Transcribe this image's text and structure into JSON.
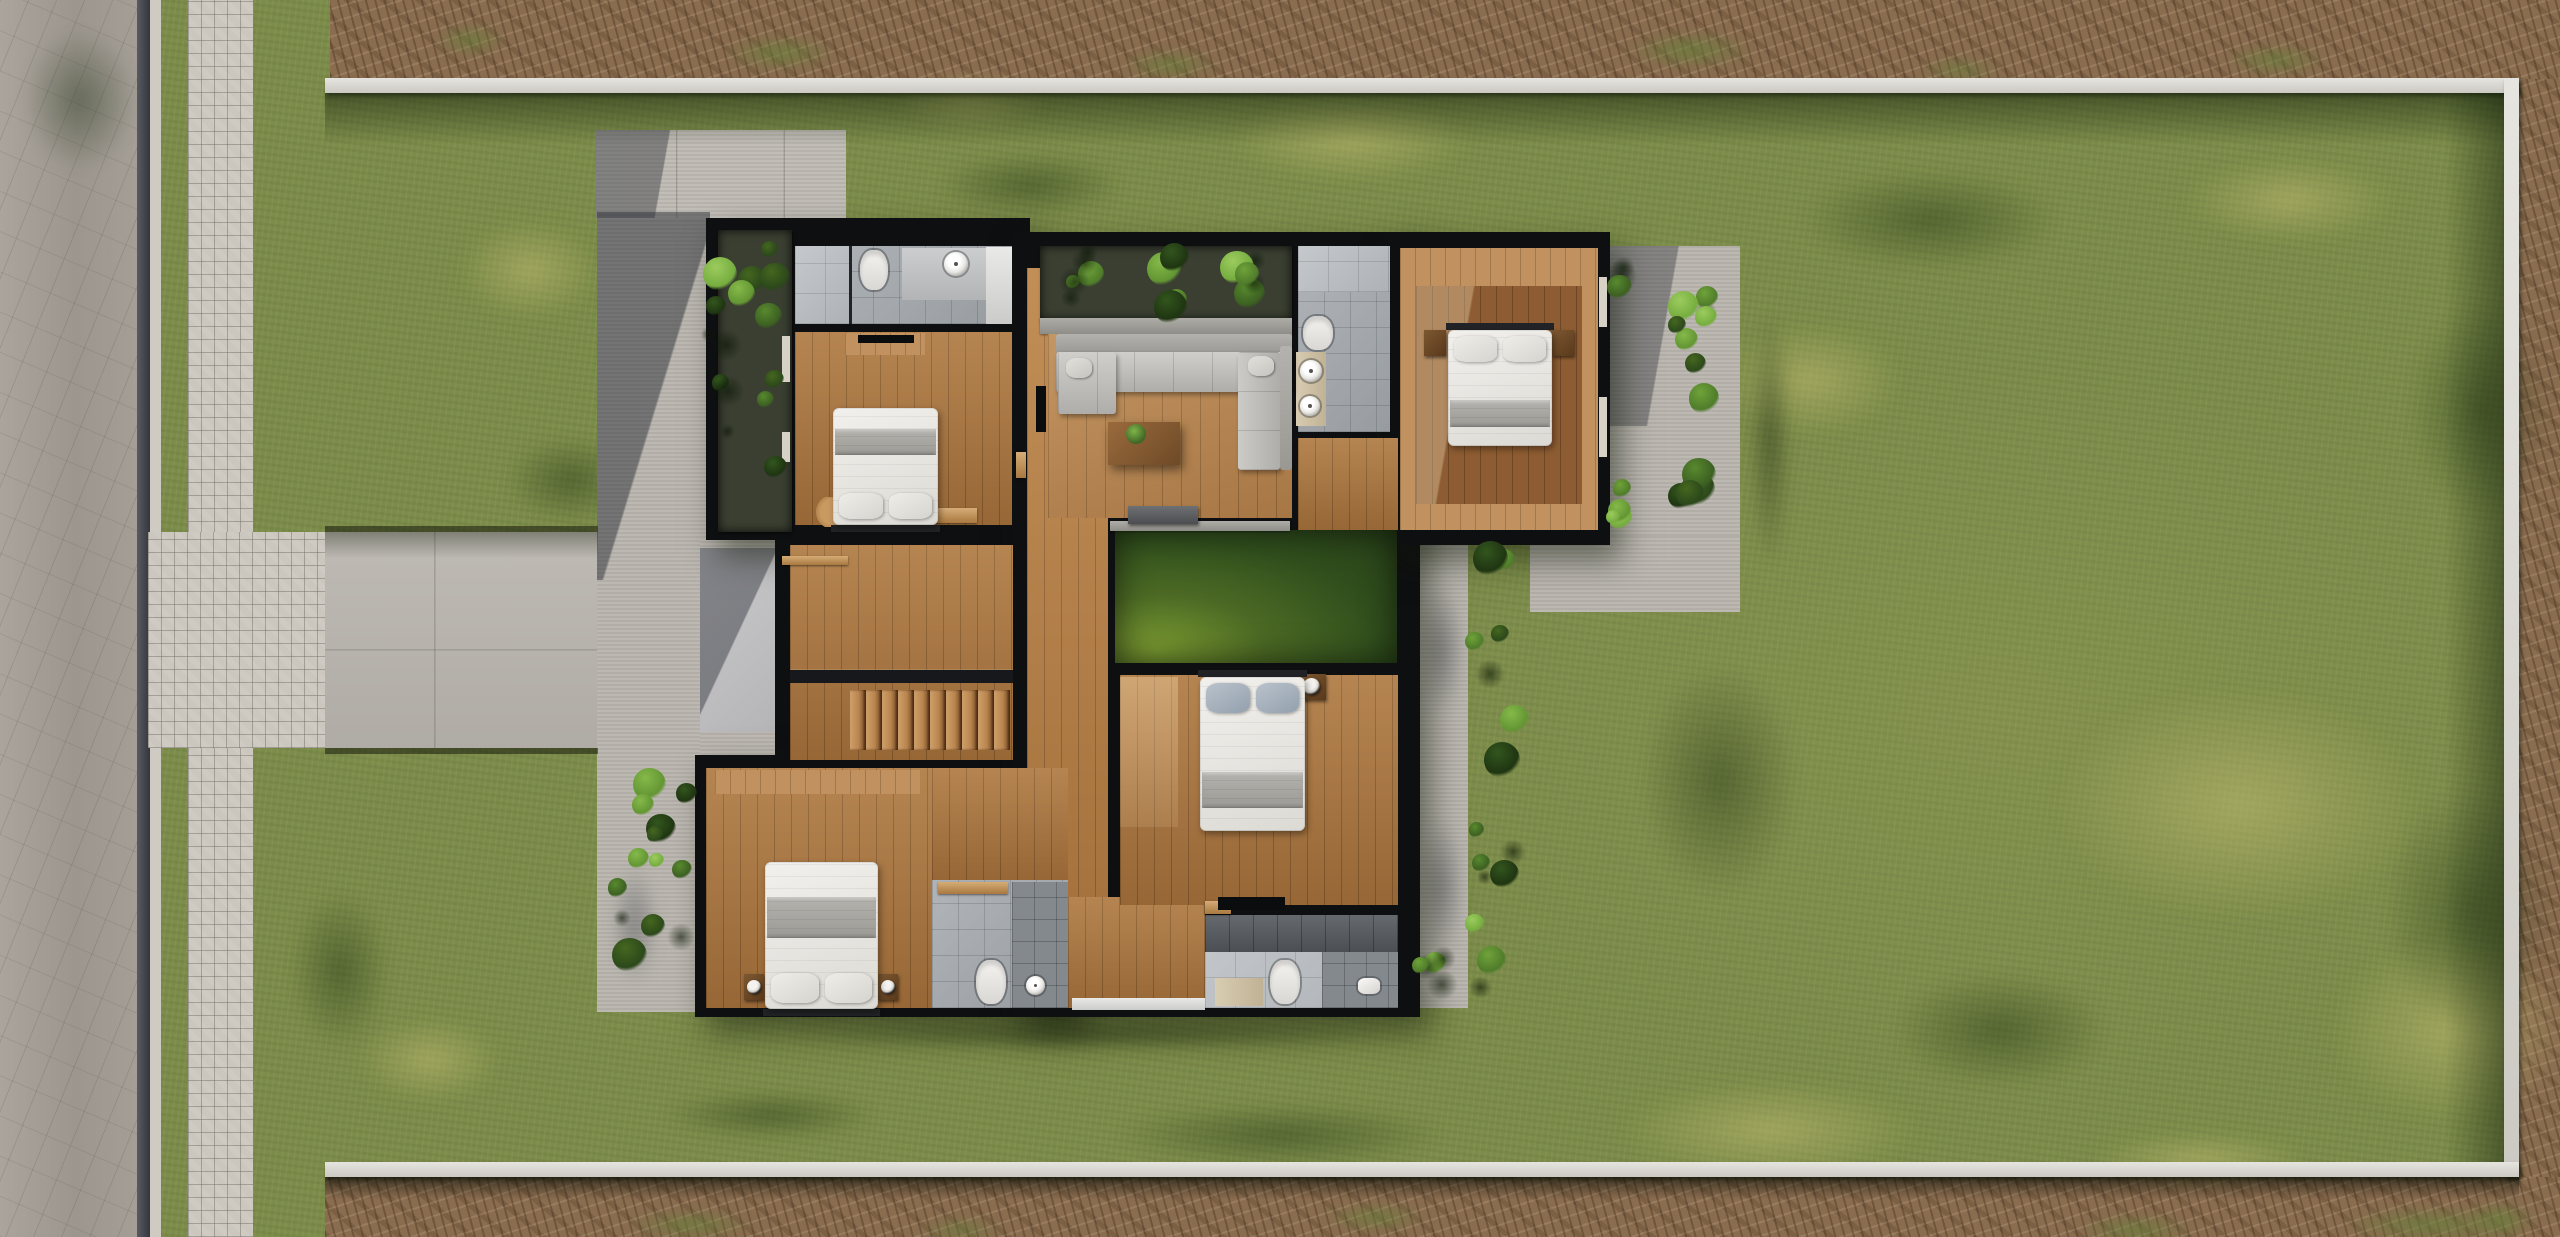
{
  "meta": {
    "scene": "photorealistic-aerial-architectural-floor-plan-render",
    "view": "top-down",
    "site": "walled rectangular lot with lawn, street and paver walkway on west side, dirt verge outside walls",
    "house": "modern single-family upper floor with 4 bedrooms, 4 bathrooms, living room, interior atrium planter, grass courtyard, staircase, terraces and perimeter planters"
  },
  "palette": {
    "grass": "#7c8c4a",
    "road": "#a19b94",
    "paver": "#cbc6be",
    "dirt": "#8a6c4f",
    "concrete": "#b9b5ae",
    "wall_white": "#dcd9d3",
    "black": "#0e0f11",
    "wood": "#a9753f",
    "woodL": "#c1925f",
    "woodD": "#8d5c32",
    "tile": "#a4a9ae",
    "tileL": "#b8bdc1",
    "tileD": "#84898e",
    "court_green": "#31501d",
    "sofa_gray": "#bdbcb8",
    "bed_white": "#e9e7e2",
    "bed_gray": "#a9a7a2",
    "pillow_blue": "#a6b0bb",
    "leaf_green": "#4f7c2a"
  },
  "regions": [
    [
      "lawn",
      "lawn",
      0,
      0,
      2560,
      1237,
      0
    ],
    [
      "road",
      "road r",
      0,
      0,
      137,
      1237,
      0
    ],
    [
      "curb-line",
      "curbD",
      137,
      0,
      13,
      1237,
      0
    ],
    [
      "curb-strip",
      "curbL",
      150,
      0,
      11,
      1237,
      0
    ],
    [
      "paver-walkway",
      "paver",
      188,
      0,
      65,
      1237,
      0
    ],
    [
      "dirt-strip-top",
      "dirt",
      330,
      0,
      2230,
      79,
      0
    ],
    [
      "dirt-strip-right",
      "dirt",
      2519,
      79,
      41,
      1158,
      0
    ],
    [
      "dirt-strip-bottom",
      "dirt",
      325,
      1177,
      2235,
      60,
      0
    ],
    [
      "paver-driveway",
      "paver",
      148,
      532,
      177,
      216,
      2
    ],
    [
      "driveway-concrete",
      "drive",
      325,
      532,
      273,
      216,
      2
    ],
    [
      "patio-west",
      "conc",
      597,
      212,
      113,
      800,
      2
    ],
    [
      "patio-entry",
      "conc",
      700,
      540,
      92,
      225,
      2
    ],
    [
      "concrete-pad-north",
      "concP",
      596,
      130,
      250,
      88,
      2
    ],
    [
      "porch-slab",
      "concL",
      700,
      548,
      85,
      184,
      2
    ],
    [
      "terrace-east-upper",
      "conc",
      1610,
      246,
      130,
      292,
      2
    ],
    [
      "terrace-east-lower",
      "conc",
      1530,
      536,
      210,
      76,
      2
    ],
    [
      "walkway-east",
      "conc",
      1406,
      536,
      62,
      472,
      2
    ],
    [
      "boundary-wall-top",
      "wallW",
      325,
      78,
      2194,
      15,
      2
    ],
    [
      "boundary-wall-right",
      "wallW",
      2504,
      78,
      15,
      1099,
      2
    ],
    [
      "boundary-wall-bottom",
      "wallW",
      325,
      1162,
      2194,
      15,
      2
    ],
    [
      "wall-top-shadow",
      "shadeT",
      325,
      93,
      2179,
      52,
      3
    ],
    [
      "wall-right-shadow",
      "shadeR",
      2444,
      93,
      60,
      1069,
      3
    ],
    [
      "wall-bottom-outer-shadow",
      "shadeB",
      325,
      1177,
      2194,
      22,
      3
    ],
    [
      "lawn-edge-top",
      "edge",
      325,
      526,
      273,
      6,
      3
    ],
    [
      "lawn-edge-bottom",
      "edge",
      325,
      748,
      273,
      6,
      3
    ],
    [
      "driveway-shadow",
      "grad",
      325,
      532,
      273,
      26,
      3,
      "background:linear-gradient(180deg,rgba(35,40,25,.4),rgba(0,0,0,0))"
    ],
    [
      "patio-shadow",
      "grad",
      597,
      212,
      113,
      368,
      3,
      "background:linear-gradient(107deg,rgba(44,47,55,.5) 52%,rgba(0,0,0,0) 53%)"
    ],
    [
      "pad-shadow",
      "grad",
      596,
      130,
      118,
      88,
      3,
      "background:linear-gradient(100deg,rgba(44,47,55,.42) 55%,rgba(0,0,0,0) 56%)"
    ],
    [
      "porch-shadow",
      "grad",
      700,
      548,
      85,
      184,
      3,
      "background:linear-gradient(115deg,rgba(44,47,55,.45) 45%,rgba(0,0,0,0) 46%)"
    ],
    [
      "terrace-shadow",
      "grad",
      1610,
      246,
      130,
      180,
      3,
      "background:linear-gradient(100deg,rgba(44,47,55,.38) 42%,rgba(0,0,0,0) 43%)"
    ],
    [
      "house-base-northwest",
      "black hshadow",
      706,
      218,
      324,
      322,
      4
    ],
    [
      "house-base-stairwell",
      "black",
      775,
      540,
      255,
      230,
      4
    ],
    [
      "house-base-southwest",
      "black hshadow",
      695,
      755,
      380,
      262,
      4
    ],
    [
      "house-base-core",
      "black hshadow",
      1012,
      232,
      408,
      785,
      4
    ],
    [
      "house-base-northeast",
      "black hshadow",
      1385,
      232,
      225,
      313,
      4
    ],
    [
      "planter-west-box",
      "pbox",
      718,
      230,
      74,
      302,
      5
    ],
    [
      "bath1-floor",
      "tile",
      795,
      246,
      217,
      78,
      5
    ],
    [
      "bath1-shower",
      "tileL",
      795,
      246,
      56,
      78,
      5
    ],
    [
      "bath1-glass-partition",
      "glass",
      849,
      246,
      3,
      78,
      5
    ],
    [
      "bath1-counter",
      "counter",
      902,
      248,
      84,
      52,
      5
    ],
    [
      "bath1-column",
      "counterW",
      986,
      247,
      26,
      77,
      5
    ],
    [
      "bedroom1-floor",
      "wood",
      795,
      332,
      217,
      193,
      5
    ],
    [
      "bedroom1-dresser",
      "woodL",
      845,
      333,
      80,
      22,
      5
    ],
    [
      "hall-floor",
      "wood",
      1027,
      268,
      81,
      740,
      5,
      "filter:brightness(1.07)"
    ],
    [
      "atrium-planter-box",
      "pbox",
      1040,
      246,
      252,
      74,
      5
    ],
    [
      "living-ledge",
      "ledge",
      1040,
      318,
      252,
      16,
      5
    ],
    [
      "living-floor",
      "woodG",
      1048,
      334,
      244,
      184,
      5
    ],
    [
      "hall2-floor",
      "wood",
      1298,
      438,
      100,
      92,
      5
    ],
    [
      "bath2-floor",
      "tile",
      1298,
      246,
      92,
      186,
      5
    ],
    [
      "bath2-shower",
      "tileL",
      1298,
      246,
      92,
      46,
      5
    ],
    [
      "bath2-vanity",
      "vanity",
      1296,
      352,
      30,
      74,
      5
    ],
    [
      "bedroom2-floor",
      "woodL",
      1400,
      248,
      198,
      282,
      5
    ],
    [
      "bedroom2-rug",
      "woodD",
      1416,
      286,
      166,
      218,
      5,
      "background-image:linear-gradient(100deg,rgba(255,235,200,.32) 28%,rgba(0,0,0,0) 29%),repeating-linear-gradient(90deg,rgba(40,20,6,.3) 0 1px,rgba(0,0,0,0) 1px 16px)"
    ],
    [
      "stair-hall-floor",
      "wood",
      790,
      545,
      223,
      215,
      5
    ],
    [
      "stair-railing",
      "rail",
      790,
      670,
      223,
      13,
      5
    ],
    [
      "bedroom3-floor",
      "wood",
      706,
      768,
      226,
      240,
      5
    ],
    [
      "bedroom3-wardrobe",
      "woodL",
      715,
      770,
      205,
      24,
      5
    ],
    [
      "hall3-floor",
      "wood",
      932,
      768,
      136,
      112,
      5
    ],
    [
      "bath3-floor",
      "tile",
      932,
      880,
      136,
      128,
      5
    ],
    [
      "bath3-shower",
      "tileD",
      1012,
      882,
      56,
      126,
      5
    ],
    [
      "bath3-door",
      "woodDoor",
      938,
      882,
      70,
      12,
      5
    ],
    [
      "vestibule-floor",
      "wood",
      1068,
      897,
      137,
      111,
      5
    ],
    [
      "vestibule-threshold",
      "counterW",
      1072,
      998,
      133,
      12,
      5
    ],
    [
      "bedroom4-floor",
      "wood",
      1120,
      675,
      278,
      230,
      5
    ],
    [
      "bedroom4-sunlight",
      "grad",
      1120,
      677,
      58,
      150,
      5,
      "background:linear-gradient(180deg,rgba(255,225,180,.35),rgba(255,225,180,.12))"
    ],
    [
      "bath4-floor",
      "tileL",
      1205,
      915,
      193,
      93,
      5
    ],
    [
      "bath4-wall-tile",
      "tileDD",
      1205,
      915,
      193,
      37,
      5
    ],
    [
      "bath4-vanity",
      "vanity",
      1215,
      978,
      48,
      28,
      5
    ],
    [
      "bath4-shower",
      "tileD",
      1322,
      952,
      76,
      56,
      5
    ],
    [
      "bath4-door",
      "woodDoor",
      1205,
      901,
      26,
      13,
      5
    ],
    [
      "bedroom4-console",
      "tv",
      1218,
      897,
      67,
      13,
      5
    ],
    [
      "courtyard-grass",
      "court",
      1115,
      530,
      282,
      133,
      5
    ],
    [
      "courtyard-coping",
      "ledge",
      1110,
      521,
      180,
      10,
      5
    ],
    [
      "hall-console",
      "benchD",
      1128,
      506,
      70,
      18,
      5
    ],
    [
      "window-slit-west1",
      "slit",
      782,
      336,
      8,
      46,
      5
    ],
    [
      "window-slit-west2",
      "slit",
      782,
      432,
      8,
      30,
      5
    ],
    [
      "door-slit-east1",
      "slit",
      1599,
      277,
      8,
      50,
      5
    ],
    [
      "door-slit-east2",
      "slit",
      1599,
      397,
      8,
      60,
      5
    ],
    [
      "stair-door",
      "woodDoor",
      782,
      556,
      66,
      9,
      5
    ],
    [
      "bedroom1-door",
      "woodDoor",
      933,
      508,
      44,
      15,
      5
    ],
    [
      "bedroom1-door-east",
      "woodDoor",
      1016,
      452,
      10,
      26,
      5
    ],
    [
      "sofa-back",
      "sofaB",
      1056,
      334,
      236,
      20,
      6
    ],
    [
      "sofa-seat",
      "sofaS",
      1056,
      352,
      236,
      40,
      6
    ],
    [
      "sofa-chaise",
      "sofaS",
      1058,
      352,
      58,
      62,
      6
    ],
    [
      "sofa-seat-vertical",
      "sofaSV",
      1238,
      352,
      42,
      118,
      6
    ],
    [
      "sofa-back-vertical",
      "sofaB",
      1280,
      346,
      12,
      124,
      6
    ],
    [
      "sofa-cushion-1",
      "sofaP",
      1066,
      358,
      26,
      20,
      6
    ],
    [
      "sofa-cushion-2",
      "sofaP",
      1248,
      356,
      26,
      20,
      6
    ],
    [
      "coffee-table",
      "table",
      1108,
      422,
      72,
      43,
      6
    ],
    [
      "tv-living",
      "tv",
      1036,
      386,
      10,
      46,
      6
    ],
    [
      "tv-bedroom1",
      "tv",
      858,
      335,
      56,
      8,
      6
    ],
    [
      "rug-bedroom1",
      "rugR",
      816,
      497,
      34,
      30,
      6
    ]
  ],
  "fixtures": [
    [
      "toilet-bath1",
      "toilet",
      860,
      250,
      28,
      40
    ],
    [
      "toilet-bath2",
      "toilet",
      1303,
      316,
      30,
      34
    ],
    [
      "toilet-bath3",
      "toilet",
      976,
      960,
      30,
      44
    ],
    [
      "toilet-bath4",
      "toilet",
      1270,
      960,
      30,
      44
    ],
    [
      "sink-bath1",
      "sink",
      944,
      252,
      24,
      24
    ],
    [
      "sink-bath2-a",
      "sink",
      1300,
      360,
      22,
      22
    ],
    [
      "sink-bath2-b",
      "sink",
      1300,
      396,
      20,
      20
    ],
    [
      "sink-bath3",
      "sink",
      1026,
      976,
      19,
      19
    ],
    [
      "sink-bath4",
      "sinkR",
      1358,
      978,
      22,
      16
    ],
    [
      "nightstand-bed2-a",
      "nightstand",
      1424,
      330,
      22,
      26
    ],
    [
      "nightstand-bed2-b",
      "nightstand",
      1552,
      330,
      22,
      26
    ],
    [
      "nightstand-bed3-a",
      "nightstand",
      744,
      974,
      20,
      26
    ],
    [
      "nightstand-bed3-b",
      "nightstand",
      878,
      974,
      20,
      26
    ],
    [
      "nightstand-bed4",
      "nightstand",
      1298,
      674,
      28,
      26
    ],
    [
      "pot-bed4",
      "pot",
      1303,
      678,
      17,
      17
    ],
    [
      "pot-bed3-a",
      "pot",
      747,
      980,
      14,
      14
    ],
    [
      "pot-bed3-b",
      "pot",
      881,
      980,
      14,
      14
    ],
    [
      "plant-coffee-table",
      "plantdot",
      1126,
      424,
      20,
      20
    ]
  ],
  "beds": [
    {
      "n": "bed-bedroom1",
      "x": 833,
      "y": 408,
      "w": 105,
      "h": 117,
      "edge": "bottom",
      "bl": [
        18,
        22
      ],
      "p": "w"
    },
    {
      "n": "bed-bedroom2",
      "x": 1448,
      "y": 330,
      "w": 104,
      "h": 116,
      "edge": "top",
      "bl": [
        60,
        24
      ],
      "p": "w"
    },
    {
      "n": "bed-bedroom3",
      "x": 765,
      "y": 862,
      "w": 113,
      "h": 147,
      "edge": "bottom",
      "bl": [
        24,
        28
      ],
      "p": "w"
    },
    {
      "n": "bed-bedroom4",
      "x": 1200,
      "y": 677,
      "w": 105,
      "h": 154,
      "edge": "top",
      "bl": [
        62,
        23
      ],
      "p": "b"
    }
  ],
  "planters": [
    {
      "n": "planter-west",
      "x": 700,
      "y": 228,
      "w": 96,
      "h": 306,
      "c": 16
    },
    {
      "n": "planter-entry",
      "x": 606,
      "y": 740,
      "w": 92,
      "h": 252,
      "c": 13
    },
    {
      "n": "planter-atrium",
      "x": 1034,
      "y": 242,
      "w": 258,
      "h": 82,
      "c": 16
    },
    {
      "n": "planter-terrace-east",
      "x": 1666,
      "y": 254,
      "w": 58,
      "h": 282,
      "c": 12
    },
    {
      "n": "planter-walkway-east",
      "x": 1458,
      "y": 530,
      "w": 72,
      "h": 474,
      "c": 15
    },
    {
      "n": "bush-southeast",
      "x": 1402,
      "y": 942,
      "w": 58,
      "h": 60,
      "c": 5
    },
    {
      "n": "plant-terrace-nw",
      "x": 1600,
      "y": 252,
      "w": 46,
      "h": 52,
      "c": 3
    },
    {
      "n": "plant-terrace-sw",
      "x": 1596,
      "y": 476,
      "w": 54,
      "h": 54,
      "c": 4
    }
  ],
  "patches": [
    [
      1980,
      640,
      520,
      330,
      "L"
    ],
    [
      2280,
      900,
      340,
      260,
      "L"
    ],
    [
      1560,
      1060,
      420,
      140,
      "L"
    ],
    [
      1180,
      80,
      340,
      120,
      "L"
    ],
    [
      2140,
      140,
      300,
      120,
      "L"
    ],
    [
      430,
      200,
      200,
      140,
      "L"
    ],
    [
      300,
      560,
      160,
      240,
      "L"
    ],
    [
      330,
      1000,
      200,
      120,
      "L"
    ],
    [
      1680,
      300,
      260,
      160,
      "L"
    ],
    [
      860,
      60,
      220,
      80,
      "L"
    ],
    [
      2050,
      1120,
      300,
      80,
      "L"
    ],
    [
      1750,
      150,
      360,
      140,
      "D"
    ],
    [
      2380,
      260,
      200,
      300,
      "D"
    ],
    [
      1610,
      620,
      220,
      320,
      "D"
    ],
    [
      1050,
      1090,
      460,
      90,
      "D"
    ],
    [
      620,
      1080,
      300,
      70,
      "D"
    ],
    [
      2350,
      740,
      240,
      340,
      "D"
    ],
    [
      480,
      420,
      180,
      120,
      "D"
    ],
    [
      270,
      860,
      140,
      220,
      "D"
    ],
    [
      1850,
      950,
      300,
      160,
      "D"
    ],
    [
      900,
      140,
      260,
      90,
      "D"
    ],
    [
      0,
      0,
      160,
      200,
      "D"
    ],
    [
      1406,
      560,
      70,
      180,
      "S"
    ],
    [
      1406,
      790,
      70,
      190,
      "S"
    ],
    [
      600,
      840,
      70,
      170,
      "S"
    ],
    [
      700,
      30,
      160,
      46,
      "G"
    ],
    [
      1100,
      45,
      140,
      40,
      "G"
    ],
    [
      1600,
      25,
      180,
      50,
      "G"
    ],
    [
      2200,
      40,
      150,
      40,
      "G"
    ],
    [
      420,
      20,
      100,
      40,
      "G"
    ],
    [
      1900,
      55,
      120,
      30,
      "G"
    ],
    [
      600,
      1205,
      180,
      40,
      "G"
    ],
    [
      1300,
      1200,
      150,
      35,
      "G"
    ],
    [
      2050,
      1210,
      170,
      40,
      "G"
    ],
    [
      2450,
      1195,
      100,
      50,
      "G"
    ],
    [
      900,
      1215,
      120,
      30,
      "G"
    ],
    [
      2300,
      1200,
      260,
      50,
      "G"
    ],
    [
      660,
      1012,
      880,
      46,
      "H"
    ],
    [
      1740,
      260,
      60,
      360,
      "H"
    ]
  ],
  "stairs": {
    "x": 850,
    "y": 690,
    "w": 160,
    "h": 60,
    "steps": 10
  }
}
